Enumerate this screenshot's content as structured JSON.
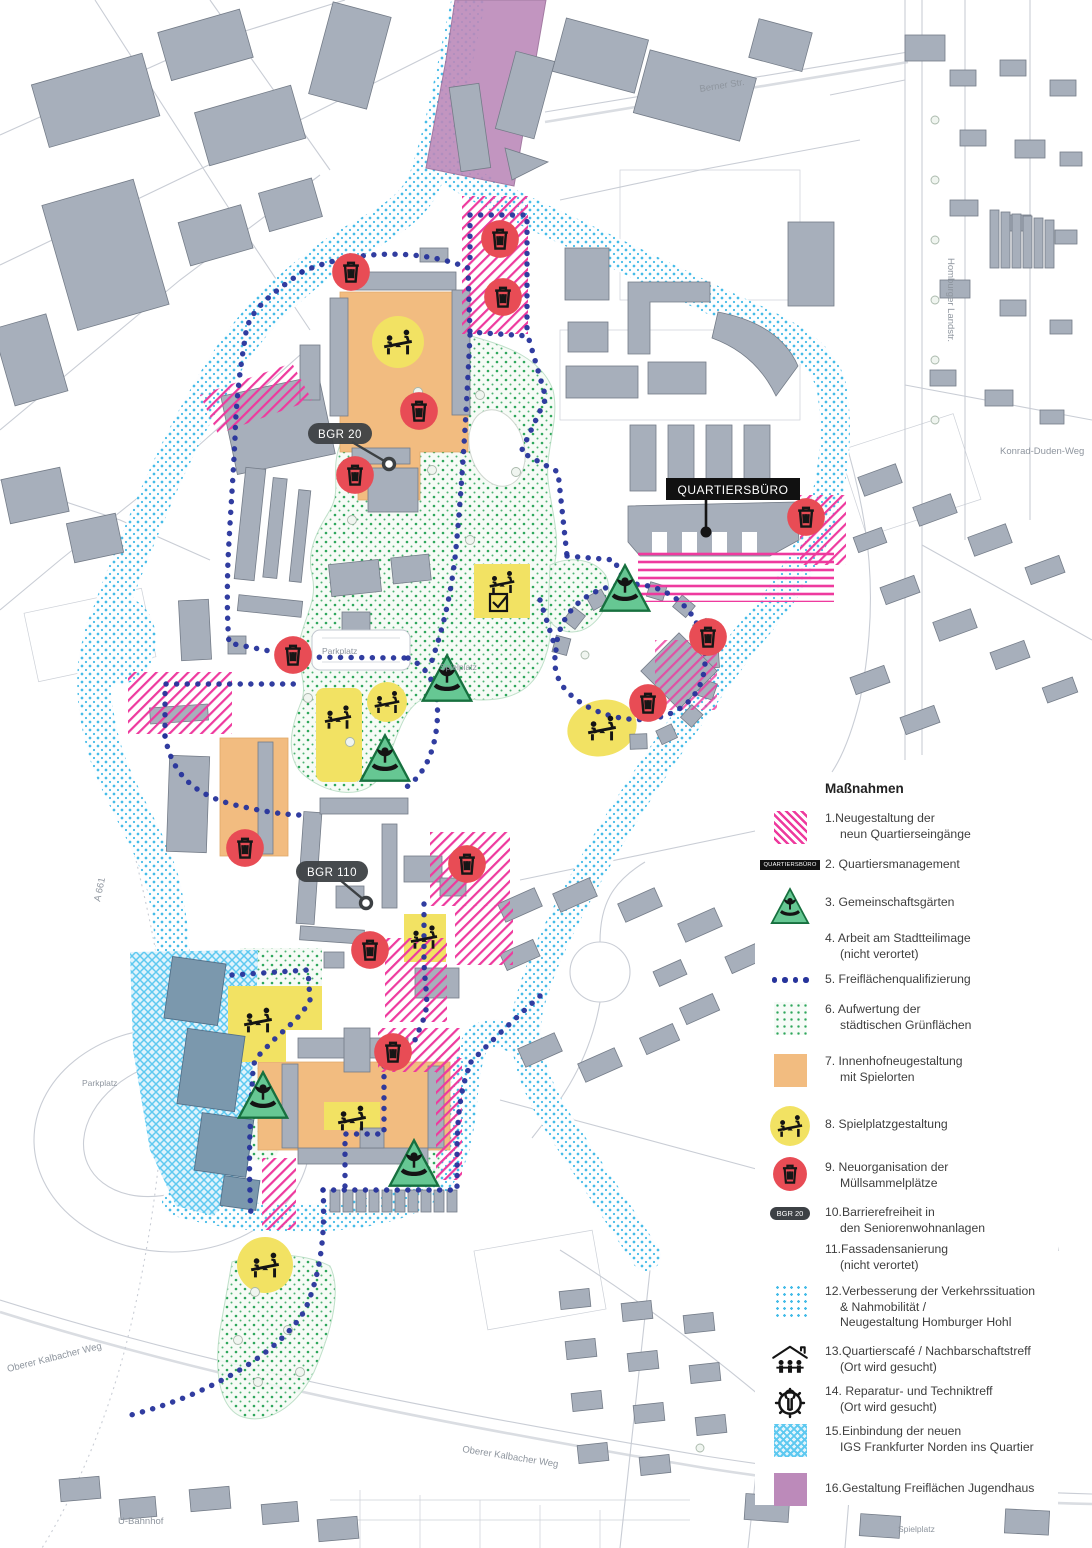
{
  "map": {
    "labels": {
      "bgr20": "BGR 20",
      "bgr110": "BGR 110",
      "quartiersbuero": "QUARTIERSBÜRO"
    },
    "street_labels": [
      {
        "text": "Berner Str."
      },
      {
        "text": "Homburger Landstr."
      },
      {
        "text": "Konrad-Duden-Weg"
      },
      {
        "text": "A 661"
      },
      {
        "text": "Oberer Kalbacher Weg"
      },
      {
        "text": "Oberer Kalbacher Weg"
      },
      {
        "text": "U-Bahnhof"
      },
      {
        "text": "Parkplatz"
      },
      {
        "text": "Parkplatz"
      },
      {
        "text": "Spielplatz"
      },
      {
        "text": "Spielplatz"
      }
    ],
    "colors": {
      "measure_pink": "#ee3a9e",
      "route_navy": "#26339b",
      "traffic_cyan": "#45bce8",
      "green_dots": "#2ea65b",
      "courtyard_orange": "#f2bc80",
      "play_yellow": "#f2e263",
      "waste_red": "#e84c55",
      "garden_green": "#66c793",
      "jugendhaus_purple": "#bc8aba",
      "igs_cyan": "#5ec9f0",
      "building_gray": "#a7afbb"
    }
  },
  "legend": {
    "title": "Maßnahmen",
    "items": [
      {
        "text": "1.Neugestaltung der\nneun Quartierseingänge",
        "swatch": "pink-hatch"
      },
      {
        "text": "2. Quartiersmanagement",
        "swatch": "quartiersbuero-label",
        "swatch_text": "QUARTIERSBÜRO"
      },
      {
        "text": "3. Gemeinschaftsgärten",
        "swatch": "garden-triangle"
      },
      {
        "text": "4. Arbeit am Stadtteilimage\n(nicht verortet)",
        "swatch": "none"
      },
      {
        "text": "5. Freiflächenqualifizierung",
        "swatch": "navy-dots"
      },
      {
        "text": "6. Aufwertung der\nstädtischen Grünflächen",
        "swatch": "green-dots"
      },
      {
        "text": "7. Innenhofneugestaltung\nmit Spielorten",
        "swatch": "orange-square"
      },
      {
        "text": "8. Spielplatzgestaltung",
        "swatch": "play-circle"
      },
      {
        "text": "9. Neuorganisation der\nMüllsammelplätze",
        "swatch": "trash-circle"
      },
      {
        "text": "10.Barrierefreiheit in\nden Seniorenwohnanlagen",
        "swatch": "bgr-pill",
        "swatch_text": "BGR 20"
      },
      {
        "text": "11.Fassadensanierung\n(nicht verortet)",
        "swatch": "none"
      },
      {
        "text": "12.Verbesserung der Verkehrssituation\n& Nahmobilität /\nNeugestaltung Homburger Hohl",
        "swatch": "cyan-dots"
      },
      {
        "text": "13.Quartierscafé / Nachbarschaftstreff\n(Ort wird gesucht)",
        "swatch": "cafe-icon"
      },
      {
        "text": "14. Reparatur- und Techniktreff\n(Ort wird gesucht)",
        "swatch": "gear-icon"
      },
      {
        "text": "15.Einbindung der neuen\nIGS Frankfurter Norden ins Quartier",
        "swatch": "igs-crosshatch"
      },
      {
        "text": "16.Gestaltung Freiflächen Jugendhaus",
        "swatch": "purple-square"
      }
    ]
  }
}
